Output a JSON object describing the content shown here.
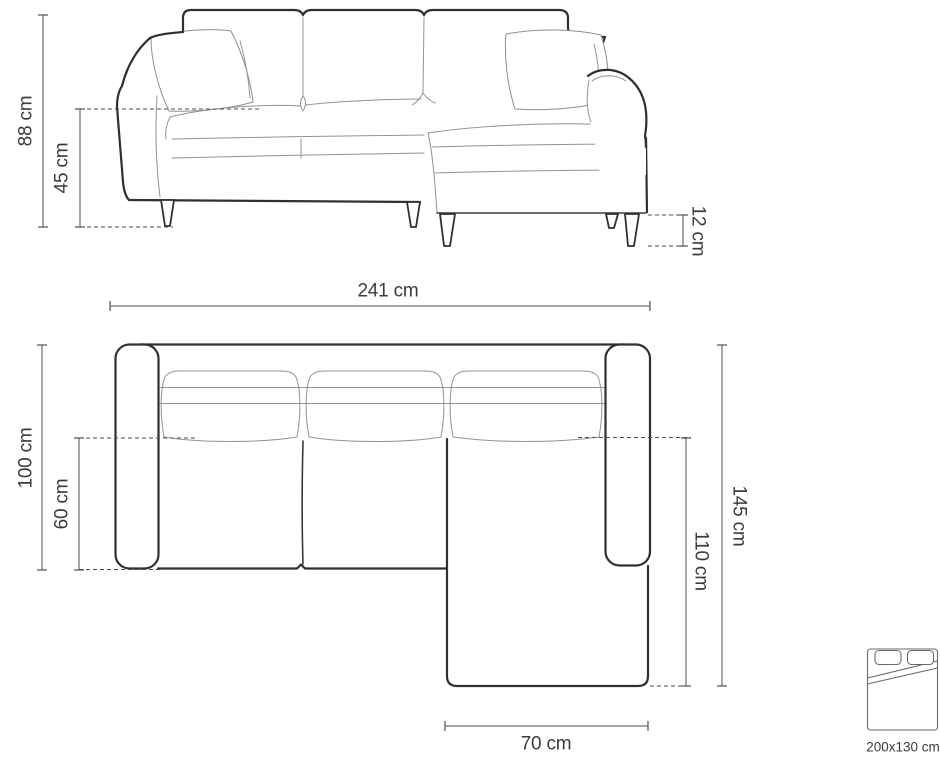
{
  "diagram_type": "sofa-dimension-drawing",
  "colors": {
    "background": "#ffffff",
    "outline": "#303030",
    "thin_line": "#949494",
    "dimension_line": "#4f4f4f",
    "label_text": "#3c3c3c"
  },
  "dimensions": {
    "front": {
      "total_height": "88 cm",
      "seat_height": "45 cm",
      "leg_height": "12 cm"
    },
    "overall_width": "241 cm",
    "top": {
      "total_depth": "100 cm",
      "seat_depth": "60 cm",
      "side_depth": "145 cm",
      "chaise_depth": "110 cm",
      "chaise_width": "70 cm"
    }
  },
  "bed_icon": {
    "label": "200x130 cm"
  }
}
